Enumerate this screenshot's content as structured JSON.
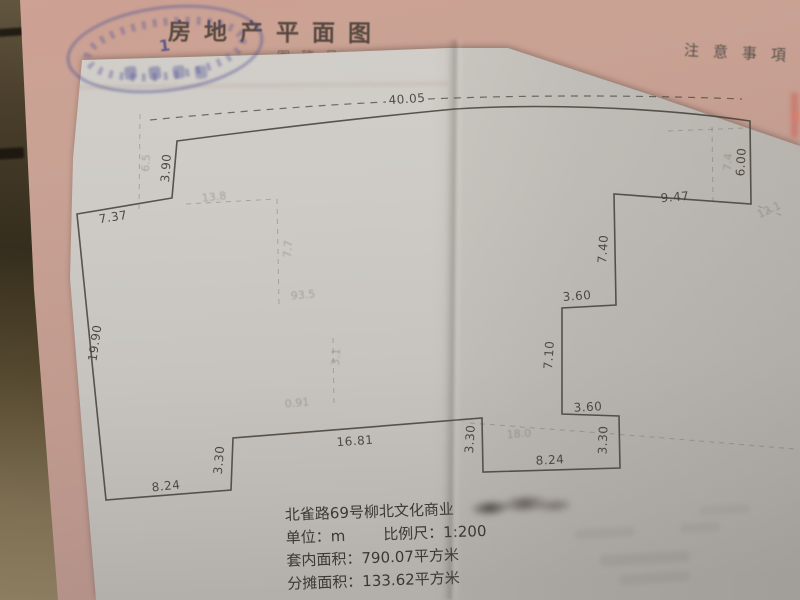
{
  "header": {
    "title": "房地产平面图",
    "partial_label": "图稿号",
    "notice_title": "注意事項",
    "stamp_number": "1"
  },
  "floor_plan": {
    "dimension_labels": [
      {
        "text": "40.05",
        "x": 407,
        "y": 99,
        "rot": -4
      },
      {
        "text": "3.90",
        "x": 166,
        "y": 168,
        "rot": -86
      },
      {
        "text": "7.37",
        "x": 113,
        "y": 217,
        "rot": -9
      },
      {
        "text": "19.90",
        "x": 95,
        "y": 343,
        "rot": -82
      },
      {
        "text": "8.24",
        "x": 166,
        "y": 486,
        "rot": -6
      },
      {
        "text": "3.30",
        "x": 219,
        "y": 460,
        "rot": -85
      },
      {
        "text": "16.81",
        "x": 355,
        "y": 441,
        "rot": -4
      },
      {
        "text": "3.30",
        "x": 470,
        "y": 439,
        "rot": -86
      },
      {
        "text": "8.24",
        "x": 550,
        "y": 460,
        "rot": -3
      },
      {
        "text": "3.30",
        "x": 603,
        "y": 440,
        "rot": -88
      },
      {
        "text": "3.60",
        "x": 588,
        "y": 407,
        "rot": -3
      },
      {
        "text": "7.10",
        "x": 549,
        "y": 355,
        "rot": -86
      },
      {
        "text": "3.60",
        "x": 577,
        "y": 296,
        "rot": -4
      },
      {
        "text": "7.40",
        "x": 603,
        "y": 249,
        "rot": -86
      },
      {
        "text": "9.47",
        "x": 675,
        "y": 197,
        "rot": -5
      },
      {
        "text": "6.00",
        "x": 741,
        "y": 162,
        "rot": -87
      }
    ],
    "ghost_labels": [
      {
        "text": "6.5",
        "x": 146,
        "y": 163,
        "rot": -86
      },
      {
        "text": "13.8",
        "x": 214,
        "y": 197,
        "rot": -6
      },
      {
        "text": "7.7",
        "x": 288,
        "y": 249,
        "rot": -86
      },
      {
        "text": "93.5",
        "x": 303,
        "y": 295,
        "rot": -5
      },
      {
        "text": "3.1",
        "x": 336,
        "y": 357,
        "rot": -86
      },
      {
        "text": "0.91",
        "x": 297,
        "y": 403,
        "rot": -5
      },
      {
        "text": "18.0",
        "x": 519,
        "y": 434,
        "rot": -4
      },
      {
        "text": "7.4",
        "x": 728,
        "y": 162,
        "rot": -86
      },
      {
        "text": "12.1",
        "x": 769,
        "y": 210,
        "rot": -25
      }
    ]
  },
  "footer": {
    "address": "北雀路69号柳北文化商业",
    "unit_label": "单位：",
    "unit_value": "m",
    "scale_label": "比例尺：",
    "scale_value": "1:200",
    "inner_area_label": "套内面积：",
    "inner_area_value": "790.07平方米",
    "apportioned_area_label": "分摊面积：",
    "apportioned_area_value": "133.62平方米"
  },
  "colors": {
    "paper_white": "#cfccc7",
    "paper_pink": "#c9a294",
    "table_dark": "#3d3428",
    "ink": "#453f38",
    "stamp_blue": "#565896"
  }
}
